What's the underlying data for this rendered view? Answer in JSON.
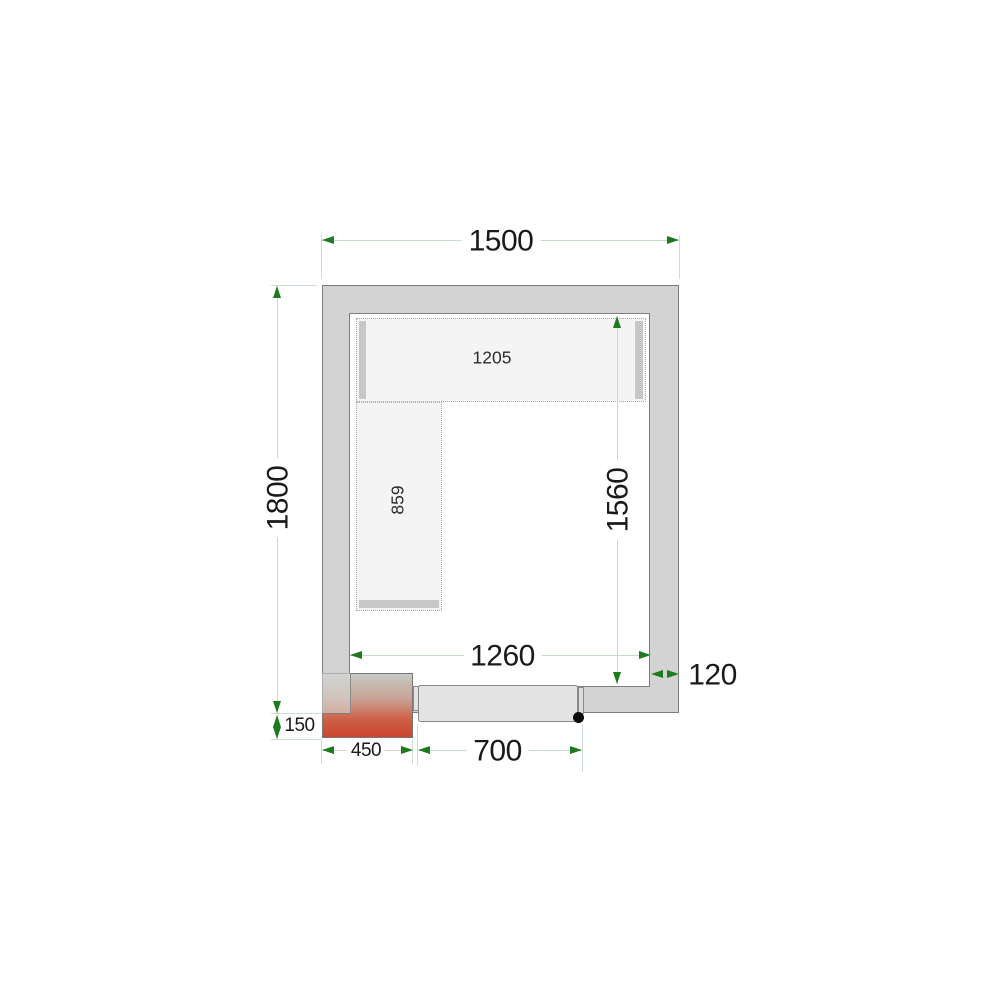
{
  "dims": {
    "width": "1500",
    "depth": "1800",
    "inner_width": "1260",
    "inner_depth": "1560",
    "wall": "120",
    "unit_offset": "150",
    "unit_width": "450",
    "door": "700"
  },
  "shelves": {
    "top": "1205",
    "side": "859"
  },
  "colors": {
    "arrow_green": "#1e7a1e",
    "dim_line": "#c9dac9",
    "wall_fill": "#d3d3d3",
    "wall_edge": "#7d7d7d",
    "shelf_fill": "#f4f4f4",
    "door_fill": "#e3e3e3",
    "unit_red": "#cc4430"
  }
}
